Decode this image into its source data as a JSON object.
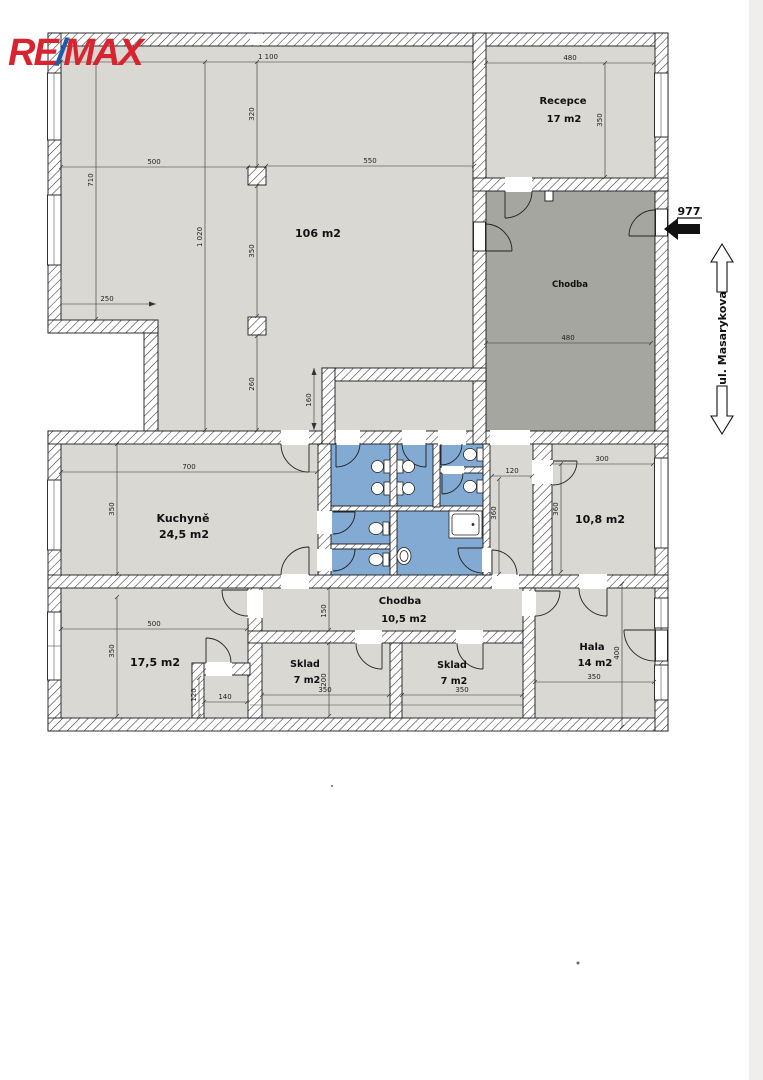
{
  "logo": {
    "re": "RE",
    "slash": "/",
    "max": "MAX"
  },
  "entrance": {
    "number": "977"
  },
  "street": {
    "label": "ul. Masarykova"
  },
  "rooms": {
    "main_hall": {
      "area": "106 m2"
    },
    "recepce": {
      "name": "Recepce",
      "area": "17 m2"
    },
    "chodba_upper": {
      "name": "Chodba"
    },
    "kuchyne": {
      "name": "Kuchyně",
      "area": "24,5 m2"
    },
    "room_108": {
      "area": "10,8 m2"
    },
    "chodba_lower": {
      "name": "Chodba",
      "area": "10,5 m2"
    },
    "room_175": {
      "area": "17,5 m2"
    },
    "sklad_left": {
      "name": "Sklad",
      "area": "7 m2"
    },
    "sklad_right": {
      "name": "Sklad",
      "area": "7 m2"
    },
    "hala": {
      "name": "Hala",
      "area": "14 m2"
    }
  },
  "dimensions": {
    "top_width": "1 100",
    "upper_height": "320",
    "left_width": "500",
    "right_width": "550",
    "left_height": "710",
    "hall_height": "1 020",
    "col_span": "350",
    "lower_span": "260",
    "notch_width": "250",
    "vestibule_height": "160",
    "recepce_width": "480",
    "recepce_height": "350",
    "chodba_width": "480",
    "kuchyne_width": "700",
    "kuchyne_height": "350",
    "wc_width": "120",
    "wc_height": "360",
    "room108_width": "300",
    "room108_height": "360",
    "room175_width": "500",
    "room175_height": "350",
    "closet_height": "120",
    "closet_width": "140",
    "chodba_lower_height": "150",
    "sklad_left_width": "350",
    "sklad_height": "200",
    "sklad_right_width": "350",
    "hala_width": "350",
    "hala_height": "400"
  },
  "colors": {
    "room": "#d9d8d3",
    "corridor_dark": "#a6a6a1",
    "wet": "#82aad2",
    "logo_red": "#d9232e",
    "logo_blue": "#1b5cab"
  }
}
